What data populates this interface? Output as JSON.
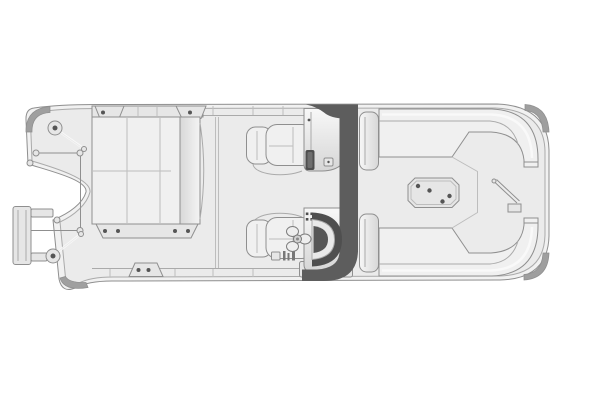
{
  "diagram": {
    "type": "pontoon-boat-floor-plan",
    "view": "top-down",
    "orientation": "bow-right-stern-left",
    "components": [
      "hull-deck",
      "rub-rail",
      "corner-bumper-stern-port",
      "corner-bumper-stern-starboard",
      "corner-bumper-bow-port",
      "corner-bumper-bow-starboard",
      "boarding-ladder",
      "ski-tow-pylon-port",
      "ski-tow-pylon-starboard",
      "motor-well-frame",
      "stern-lounge-bench",
      "stern-lounge-chaise",
      "rail-mount-plates",
      "deck-cleat-plate",
      "port-captain-chair",
      "starboard-helm-chair",
      "passenger-console",
      "glove-slot",
      "console-latch",
      "helm-console",
      "windshield",
      "steering-wheel",
      "instrument-panel",
      "canopy-arch",
      "port-armrest-panel",
      "starboard-armrest-panel",
      "bow-lounge-port",
      "bow-lounge-starboard",
      "bow-table",
      "bow-gate",
      "deck-seams"
    ]
  },
  "colors": {
    "page-bg": "#ffffff",
    "hull-fill": "#f1f1f1",
    "deck-fill": "#ebebeb",
    "panel-fill": "#e6e6e6",
    "cushion": "#f0f0f0",
    "line": "#8f8f8f",
    "line-soft": "#aaaaaa",
    "seam": "#bdbdbd",
    "dark": "#5d5d5d",
    "dark-deep": "#4f4f4f",
    "dot": "#555555",
    "bumper": "#9f9f9f",
    "highlight": "#fafafa"
  }
}
